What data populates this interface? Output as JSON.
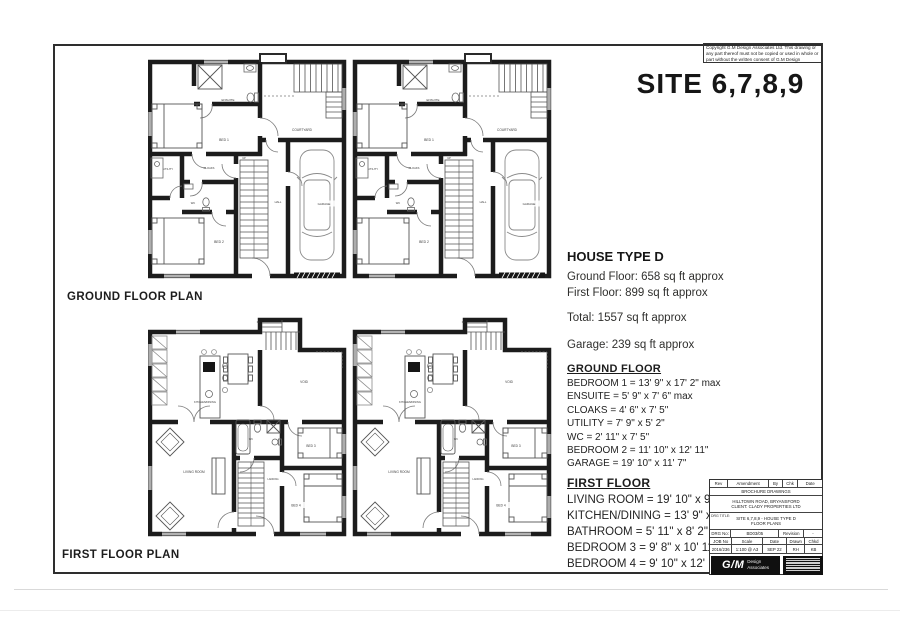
{
  "copyright": {
    "text": "Copyright G.M Design Associates Ltd. This drawing or any part thereof must not be copied or used in whole or part without the written consent of G.M Design Associates Ltd."
  },
  "site": {
    "title": "SITE 6,7,8,9"
  },
  "plans": {
    "ground": {
      "caption": "GROUND FLOOR PLAN",
      "rooms": {
        "ensuite": "ENSUITE",
        "bed1": "BED 1",
        "courtyard": "COURTYARD",
        "utility": "UTILITY",
        "cloaks": "CLOAKS",
        "wc": "WC",
        "hall": "HALL",
        "up": "UP",
        "bed2": "BED 2",
        "garage": "GARAGE"
      }
    },
    "first": {
      "caption": "FIRST FLOOR PLAN",
      "rooms": {
        "kitchen": "KITCHEN/DINING",
        "void": "VOID",
        "living": "LIVING ROOM",
        "landing": "LANDING",
        "wc": "WC",
        "bed3": "BED 3",
        "bed4": "BED 4",
        "dn": "Dn"
      }
    }
  },
  "spec": {
    "house_type": "HOUSE TYPE D",
    "ground_floor_area": "Ground Floor: 658 sq ft approx",
    "first_floor_area": "First Floor: 899 sq ft approx",
    "total_area": "Total: 1557 sq ft approx",
    "garage_area": "Garage: 239 sq ft approx",
    "ground_floor": {
      "heading": "GROUND FLOOR",
      "items": [
        "BEDROOM 1 = 13' 9\" x 17' 2\" max",
        "ENSUITE = 5' 9\" x 7' 6\" max",
        "CLOAKS = 4' 6\" x 7' 5\"",
        "UTILITY = 7' 9\" x 5' 2\"",
        "WC = 2' 11\" x 7' 5\"",
        "BEDROOM 2 = 11' 10\" x 12' 11\"",
        "GARAGE = 19' 10\" x 11' 7\""
      ]
    },
    "first_floor": {
      "heading": "FIRST FLOOR",
      "items": [
        "LIVING ROOM = 19' 10\" x 9' 11\"",
        "KITCHEN/DINING = 13' 9\" x 17' 2\"",
        "BATHROOM = 5' 11\" x 8' 2\"",
        "BEDROOM 3 = 9' 8\" x 10' 11\"",
        "BEDROOM 4 = 9' 10\" x 12' 1\""
      ]
    }
  },
  "title_block": {
    "cols": [
      "Rev",
      "Amendment",
      "By",
      "Chk",
      "Date"
    ],
    "status": "BROCHURE DRAWINGS",
    "project_line1": "HILLTOWN ROAD, BRYANSFORD",
    "project_line2": "CLIENT: CLADY PROPERTIES LTD",
    "drg_title_label": "DRG TITLE:",
    "drg_title_line1": "SITE 6,7,8,9 - HOUSE TYPE D",
    "drg_title_line2": "FLOOR PLANS",
    "drg_no_label": "DRG No:",
    "drg_no": "BD03/05",
    "revision_label": "Revision",
    "revision_value": "-",
    "job_cols": [
      "JOB No",
      "Scale",
      "Date",
      "Drawn",
      "Chkd"
    ],
    "job_vals": [
      "2016/236",
      "1:100 @ A3",
      "SEP 22",
      "RH",
      "KB"
    ],
    "logo_text": "G/M",
    "logo_sub1": "Design",
    "logo_sub2": "Associates"
  }
}
